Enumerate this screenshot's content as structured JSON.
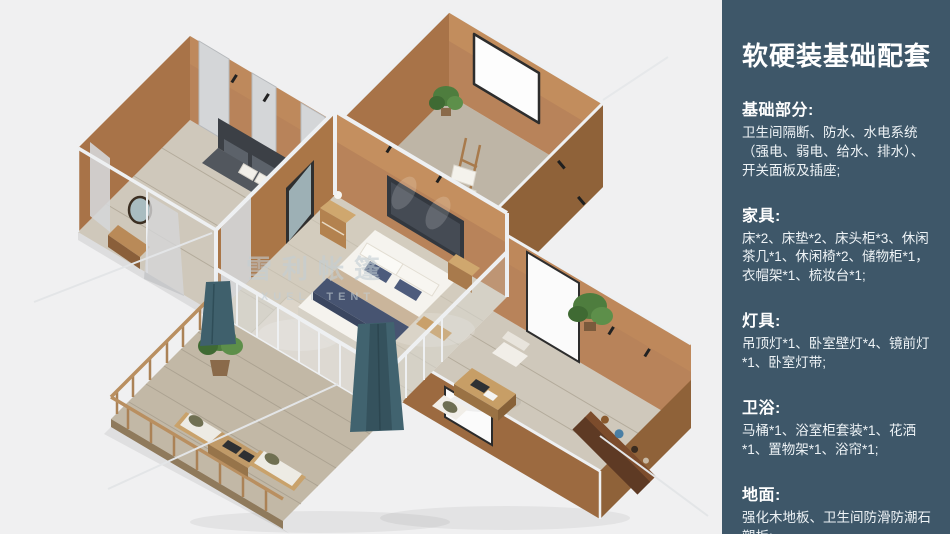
{
  "palette": {
    "bg": "#f0f0f1",
    "sidebarBg": "#3e5769",
    "wall": "#b8835a",
    "wallMid": "#a87348",
    "wallDark": "#8f6239",
    "frame": "#eef0f2",
    "floor": "#cfc8bb",
    "floorDark": "#beb5a6",
    "deck": "#c2b8a6",
    "plank": "#a89f8e",
    "curtain": "#d4d6d8",
    "teal": "#3f606c",
    "wood": "#b98a58"
  },
  "sidebar": {
    "title": "软硬装基础配套",
    "sections": [
      {
        "heading": "基础部分:",
        "body": "卫生间隔断、防水、水电系统（强电、弱电、给水、排水）、开关面板及插座;"
      },
      {
        "heading": "家具:",
        "body": "床*2、床垫*2、床头柜*3、休闲茶几*1、休闲椅*2、储物柜*1，衣帽架*1、梳妆台*1;"
      },
      {
        "heading": "灯具:",
        "body": "吊顶灯*1、卧室壁灯*4、镜前灯*1、卧室灯带;"
      },
      {
        "heading": "卫浴:",
        "body": "马桶*1、浴室柜套装*1、花洒*1、置物架*1、浴帘*1;"
      },
      {
        "heading": "地面:",
        "body": "强化木地板、卫生间防滑防潮石塑板;"
      }
    ]
  },
  "illustration": {
    "watermark_cn": "雪利帐篷",
    "watermark_en": "XUELI TENT"
  }
}
